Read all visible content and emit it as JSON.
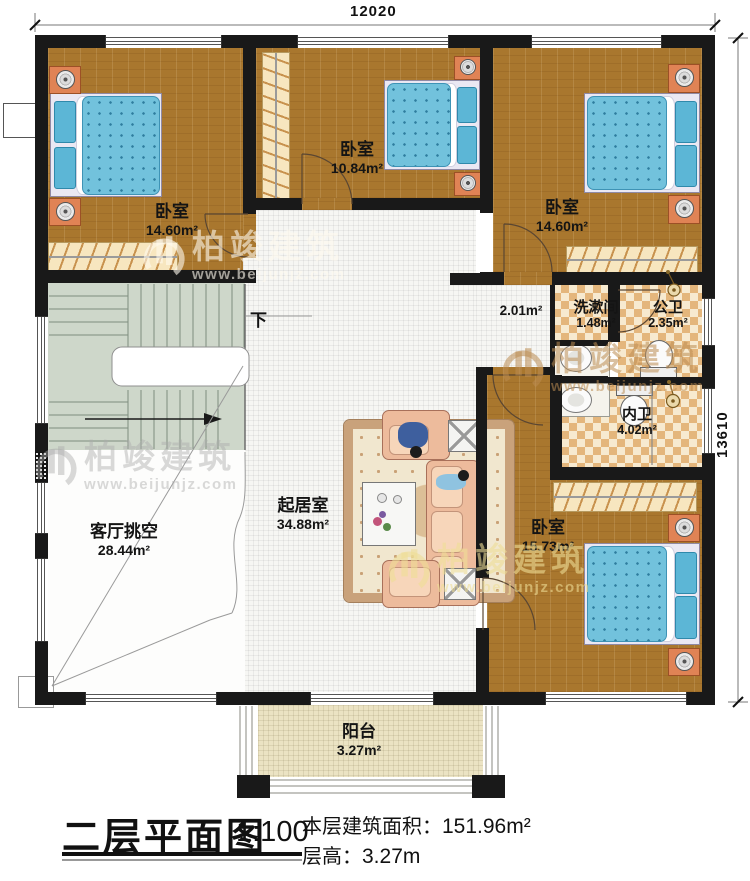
{
  "title_block": {
    "plan_title": "二层平面图",
    "scale": "1:100",
    "area_label": "本层建筑面积：",
    "area_value": "151.96m²",
    "height_label": "层高：",
    "height_value": "3.27m"
  },
  "dimensions": {
    "top": "12020",
    "right": "13610"
  },
  "rooms": [
    {
      "id": "bedroom-1",
      "name": "卧室",
      "area": "14.60m²"
    },
    {
      "id": "bedroom-2",
      "name": "卧室",
      "area": "10.84m²"
    },
    {
      "id": "bedroom-3",
      "name": "卧室",
      "area": "14.60m²"
    },
    {
      "id": "hallway",
      "name": "",
      "area": "2.01m²"
    },
    {
      "id": "washroom",
      "name": "洗漱间",
      "area": "1.48m²"
    },
    {
      "id": "public-bath",
      "name": "公卫",
      "area": "2.35m²"
    },
    {
      "id": "private-bath",
      "name": "内卫",
      "area": "4.02m²"
    },
    {
      "id": "bedroom-4",
      "name": "卧室",
      "area": "15.73m²"
    },
    {
      "id": "living-room",
      "name": "起居室",
      "area": "34.88m²"
    },
    {
      "id": "living-void",
      "name": "客厅挑空",
      "area": "28.44m²"
    },
    {
      "id": "balcony",
      "name": "阳台",
      "area": "3.27m²"
    }
  ],
  "stairs": {
    "down_label": "下"
  },
  "watermark": {
    "name": "柏竣建筑",
    "url": "www.beijunjz.com"
  },
  "colors": {
    "wall": "#191919",
    "wood_floor": "#a9772e",
    "bath_tile": "#e4b67c",
    "stair_green": "#ced7ca",
    "bed_blue": "#72c2dc",
    "sofa_salmon": "#edbb9c",
    "balcony_floor": "#ebe3c3",
    "nightstand_orange": "#e08355"
  }
}
